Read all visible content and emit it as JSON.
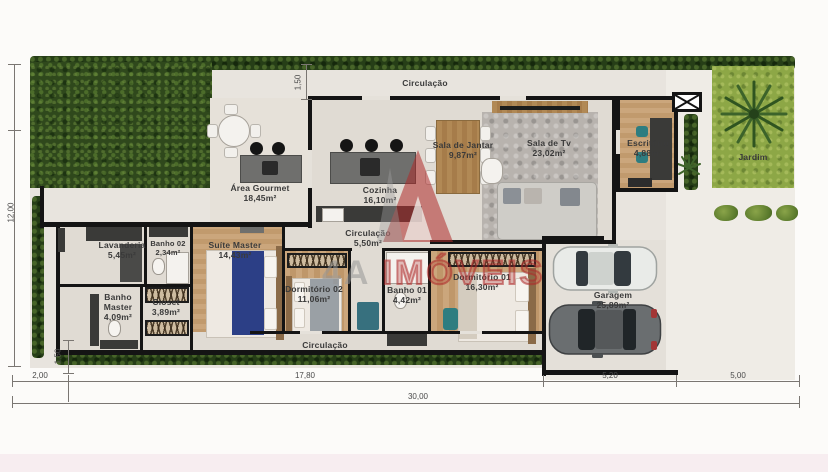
{
  "watermark": {
    "prefix": "4A",
    "name": "IMÓVEIS",
    "accent_color": "#af2a2a"
  },
  "rooms": {
    "circulacao_top": {
      "name": "Circulação"
    },
    "area_gourmet": {
      "name": "Área Gourmet",
      "area": "18,45m²"
    },
    "cozinha": {
      "name": "Cozinha",
      "area": "16,10m²"
    },
    "sala_jantar": {
      "name": "Sala de Jantar",
      "area": "9,87m²"
    },
    "sala_tv": {
      "name": "Sala de Tv",
      "area": "23,02m²"
    },
    "escritorio": {
      "name": "Escritório",
      "area": "4,88m²"
    },
    "jardim": {
      "name": "Jardim"
    },
    "lavanderia": {
      "name": "Lavanderia",
      "area": "5,45m²"
    },
    "banho02": {
      "name": "Banho 02",
      "area": "2,34m²"
    },
    "suite_master": {
      "name": "Suíte Master",
      "area": "14,43m²"
    },
    "banho_master": {
      "name": "Banho Master",
      "area": "4,09m²"
    },
    "closet": {
      "name": "Closet",
      "area": "3,89m²"
    },
    "circulacao_meio": {
      "name": "Circulação",
      "area": "5,50m²"
    },
    "dormitorio02": {
      "name": "Dormitório 02",
      "area": "11,06m²"
    },
    "banho01": {
      "name": "Banho 01",
      "area": "4,42m²"
    },
    "dormitorio01": {
      "name": "Dormitório 01",
      "area": "16,30m²"
    },
    "garagem": {
      "name": "Garagem",
      "area": "25,89m²"
    },
    "circulacao_fundo": {
      "name": "Circulação"
    }
  },
  "dimensions": {
    "left_total": "12,00",
    "top_setback": "1,50",
    "corridor_width": "1,50",
    "bottom_segments": [
      "2,00",
      "17,80",
      "5,20",
      "5,00"
    ],
    "total_width": "30,00"
  },
  "colors": {
    "hedge_green": "#263e17",
    "garden_green": "#8da746",
    "wall_black": "#141414"
  }
}
